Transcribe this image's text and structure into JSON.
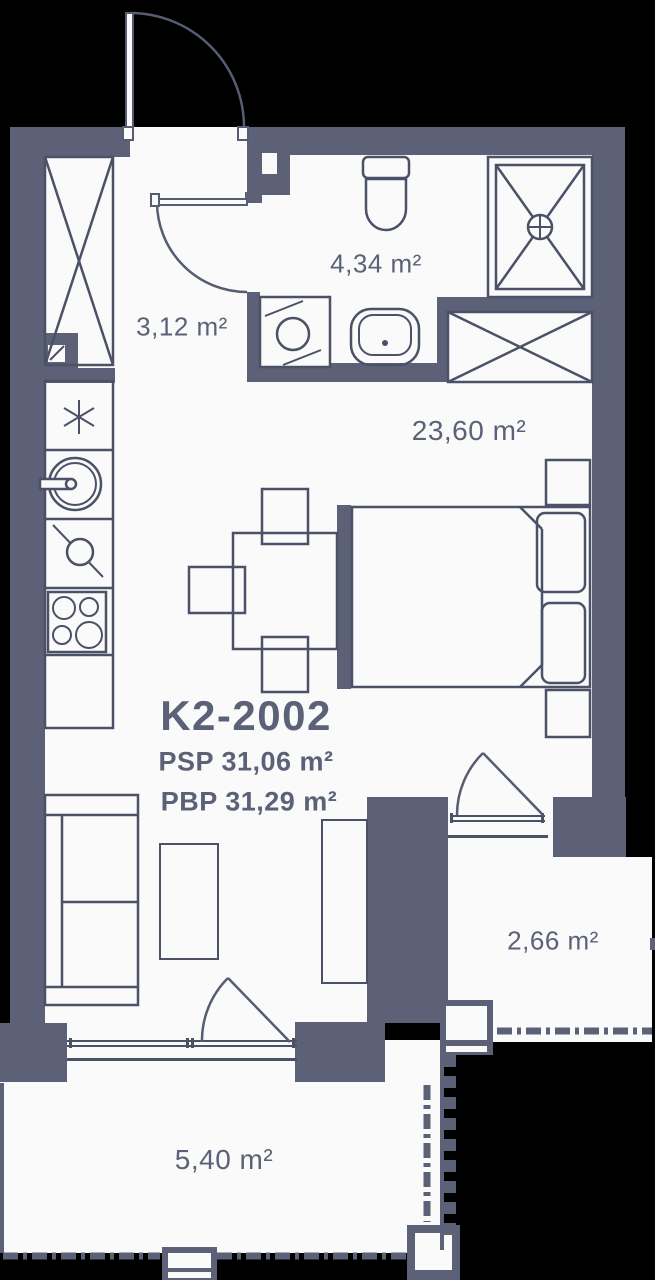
{
  "floor_plan": {
    "unit": {
      "id": "K2-2002",
      "psp": "PSP 31,06 m²",
      "pbp": "PBP 31,29 m²"
    },
    "rooms": [
      {
        "name": "hallway",
        "area": "3,12 m²"
      },
      {
        "name": "bathroom",
        "area": "4,34 m²"
      },
      {
        "name": "living-room",
        "area": "23,60 m²"
      },
      {
        "name": "balcony-side",
        "area": "2,66 m²"
      },
      {
        "name": "balcony-bottom",
        "area": "5,40 m²"
      }
    ],
    "icons": [
      "fridge-asterisk-icon",
      "kitchen-sink-icon",
      "cabinet-icon",
      "stove-icon",
      "toilet-icon",
      "shower-drain-icon",
      "washing-machine-icon",
      "washbasin-icon",
      "wardrobe-cross-icon",
      "door-swing-icon",
      "railing-dashes",
      "sawtooth-edge"
    ],
    "colors": {
      "background": "#000000",
      "wall": "#5c6177",
      "line": "#4b5166",
      "floor": "#fafafb",
      "text": "#5b6177"
    }
  }
}
